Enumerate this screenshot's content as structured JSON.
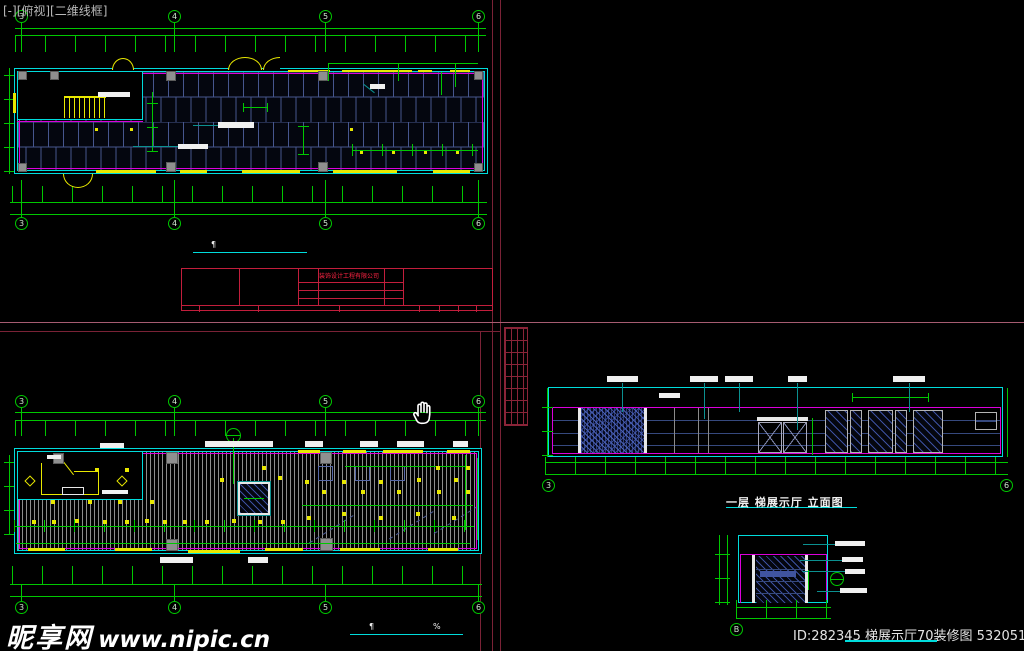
{
  "viewport_label": "[-][俯视][二维线框]",
  "watermark": {
    "site_name": "昵享网",
    "site_url": "www.nipic.cn"
  },
  "id_watermark": {
    "text": "ID:282345 梯展示厅70装修图 53205132000"
  },
  "title_block": {
    "company": "装饰设计工程有限公司"
  },
  "drawings": {
    "elevation": {
      "title": "一层 梯展示厅 立面图"
    },
    "scale_mark_left": "¶",
    "scale_mark_right": "%"
  },
  "grid": {
    "labels": [
      "3",
      "4",
      "5",
      "6"
    ],
    "xs": [
      15,
      168,
      319,
      472
    ],
    "elevation_left": "3",
    "elevation_right": "6",
    "section_bubble": "B"
  },
  "colors": {
    "dim_green": "#00c800",
    "wall_cyan": "#00dcdc",
    "wall_magenta": "#dc00dc",
    "fixture_yellow": "#e8e800",
    "tile_blue": "#46568e",
    "sheet_red": "#7a2236",
    "titleblock_red": "#c21e3c"
  },
  "decor": {
    "ceiling_lights": [
      [
        95,
        468
      ],
      [
        125,
        468
      ],
      [
        220,
        478
      ],
      [
        262,
        466
      ],
      [
        278,
        476
      ],
      [
        305,
        480
      ],
      [
        322,
        490
      ],
      [
        342,
        480
      ],
      [
        361,
        490
      ],
      [
        379,
        480
      ],
      [
        397,
        490
      ],
      [
        417,
        478
      ],
      [
        437,
        490
      ],
      [
        454,
        478
      ],
      [
        466,
        490
      ],
      [
        307,
        516
      ],
      [
        342,
        512
      ],
      [
        379,
        516
      ],
      [
        416,
        512
      ],
      [
        452,
        516
      ],
      [
        32,
        520
      ],
      [
        52,
        520
      ],
      [
        75,
        519
      ],
      [
        103,
        520
      ],
      [
        125,
        520
      ],
      [
        145,
        519
      ],
      [
        163,
        520
      ],
      [
        183,
        520
      ],
      [
        205,
        520
      ],
      [
        232,
        519
      ],
      [
        258,
        520
      ],
      [
        281,
        520
      ],
      [
        51,
        500
      ],
      [
        88,
        500
      ],
      [
        118,
        500
      ],
      [
        150,
        500
      ],
      [
        436,
        466
      ],
      [
        466,
        466
      ]
    ],
    "plan_dots": [
      [
        360,
        151
      ],
      [
        392,
        151
      ],
      [
        424,
        151
      ],
      [
        456,
        151
      ],
      [
        95,
        128
      ],
      [
        130,
        128
      ],
      [
        350,
        128
      ]
    ],
    "plan_label_bars": [
      [
        98,
        92,
        32,
        5
      ],
      [
        218,
        122,
        36,
        6
      ],
      [
        178,
        144,
        30,
        5
      ],
      [
        370,
        84,
        15,
        5
      ]
    ],
    "ceiling_label_bars": [
      [
        205,
        441,
        68,
        6
      ],
      [
        305,
        441,
        18,
        6
      ],
      [
        360,
        441,
        18,
        6
      ],
      [
        397,
        441,
        27,
        6
      ],
      [
        453,
        441,
        15,
        6
      ],
      [
        100,
        443,
        24,
        5
      ],
      [
        47,
        455,
        14,
        4
      ],
      [
        102,
        490,
        26,
        4
      ],
      [
        160,
        557,
        33,
        6
      ],
      [
        248,
        557,
        20,
        6
      ]
    ],
    "elevation_label_bars": [
      [
        607,
        376,
        31,
        6
      ],
      [
        690,
        376,
        28,
        6
      ],
      [
        725,
        376,
        28,
        6
      ],
      [
        788,
        376,
        19,
        6
      ],
      [
        893,
        376,
        32,
        6
      ],
      [
        659,
        393,
        21,
        5
      ]
    ],
    "section_label_bars": [
      [
        835,
        541,
        30,
        5
      ],
      [
        842,
        557,
        21,
        5
      ],
      [
        845,
        569,
        20,
        5
      ],
      [
        840,
        588,
        27,
        5
      ]
    ],
    "cabinets": [
      [
        825,
        23
      ],
      [
        850,
        12
      ],
      [
        868,
        25
      ],
      [
        895,
        12
      ],
      [
        913,
        30
      ]
    ],
    "elevation_leaders": [
      [
        622,
        383,
        29
      ],
      [
        704,
        383,
        36
      ],
      [
        739,
        383,
        29
      ],
      [
        797,
        383,
        47
      ],
      [
        909,
        383,
        29
      ]
    ],
    "section_leaders": [
      [
        803,
        544,
        33
      ],
      [
        800,
        560,
        43
      ],
      [
        802,
        571,
        44
      ],
      [
        817,
        591,
        24
      ]
    ]
  }
}
